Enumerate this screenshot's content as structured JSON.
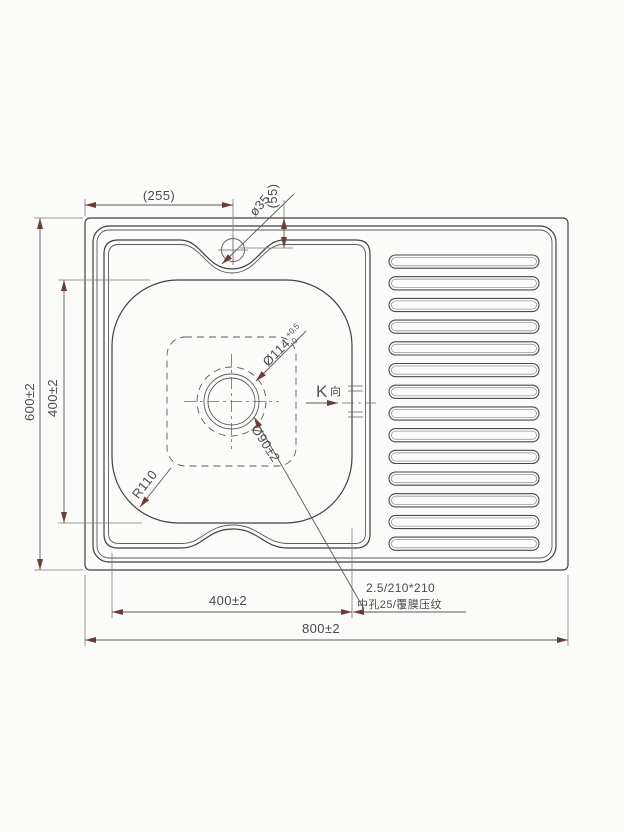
{
  "drawing": {
    "type": "technical-drawing",
    "subject": "single bowl sink with drainboard - top view",
    "colors": {
      "background": "#fbfbfa",
      "line": "#414141",
      "dimension": "#585858",
      "arrow": "#6e3c36"
    },
    "dims": {
      "top_width": "(255)",
      "faucet_hole_dia": "ø35",
      "faucet_offset": "(55)",
      "overall_height": "600±2",
      "bowl_height": "400±2",
      "bowl_width": "400±2",
      "overall_width": "800±2",
      "corner_radius": "R110",
      "drain_dia": "Ø114",
      "drain_tol_upper": "+0.5",
      "drain_tol_lower": "0",
      "drain_opening": "Ø90±2",
      "view_letter": "K",
      "view_char": "向",
      "note_line1": "2.5/210*210",
      "note_line2": "中孔25/覆膜压纹"
    },
    "ribs": {
      "count": 14
    }
  }
}
